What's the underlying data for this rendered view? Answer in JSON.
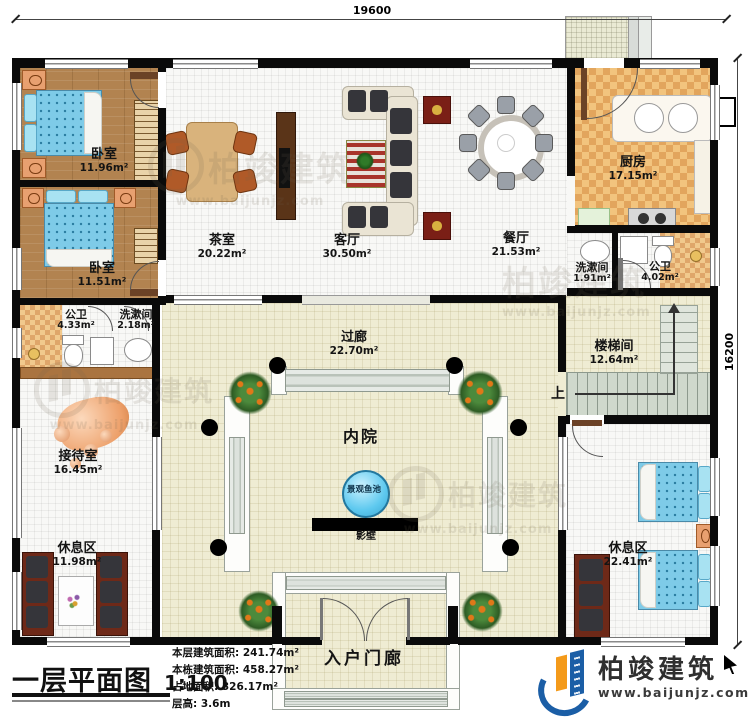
{
  "dimensions": {
    "top_width": "19600",
    "right_height": "16200"
  },
  "rooms": {
    "bedroom_1": {
      "name": "卧室",
      "area": "11.96m²"
    },
    "bedroom_2": {
      "name": "卧室",
      "area": "11.51m²"
    },
    "tea_room": {
      "name": "茶室",
      "area": "20.22m²"
    },
    "living_room": {
      "name": "客厅",
      "area": "30.50m²"
    },
    "dining_room": {
      "name": "餐厅",
      "area": "21.53m²"
    },
    "kitchen": {
      "name": "厨房",
      "area": "17.15m²"
    },
    "washroom_right": {
      "name": "洗漱间",
      "area": "1.91m²"
    },
    "bathroom_right": {
      "name": "公卫",
      "area": "4.02m²"
    },
    "bathroom_left": {
      "name": "公卫",
      "area": "4.33m²"
    },
    "washroom_left": {
      "name": "洗漱间",
      "area": "2.18m²"
    },
    "corridor": {
      "name": "过廊",
      "area": "22.70m²"
    },
    "stairwell": {
      "name": "楼梯间",
      "area": "12.64m²"
    },
    "stair_direction": {
      "name": "上"
    },
    "reception": {
      "name": "接待室",
      "area": "16.45m²"
    },
    "courtyard": {
      "name": "内院"
    },
    "fish_pond": {
      "name": "景观鱼池"
    },
    "screen_wall": {
      "name": "影壁"
    },
    "rest_area_left": {
      "name": "休息区",
      "area": "11.98m²"
    },
    "rest_area_right": {
      "name": "休息区",
      "area": "22.41m²"
    },
    "entrance_porch": {
      "name": "入户门廊"
    }
  },
  "stats": [
    "本层建筑面积: 241.74m²",
    "本栋建筑面积: 458.27m²",
    "占地面积: 326.17m²",
    "层高: 3.6m"
  ],
  "title_block": {
    "title": "一层平面图",
    "scale": "1:100"
  },
  "branding": {
    "company": "柏竣建筑",
    "website": "www.baijunjz.com"
  },
  "watermark": {
    "text": "柏竣建筑",
    "website": "www.baijunjz.com"
  },
  "colors": {
    "wall": "#0a0a0a",
    "courtyard_floor": "#efecd3",
    "wood_floor": "#b28350",
    "kitchen_checker": "#e2a55d",
    "pond_blue": "#5ec9ef",
    "bed_blue": "#7ecbe8",
    "logo_blue": "#1b5ea6",
    "logo_orange": "#f49a1a"
  }
}
